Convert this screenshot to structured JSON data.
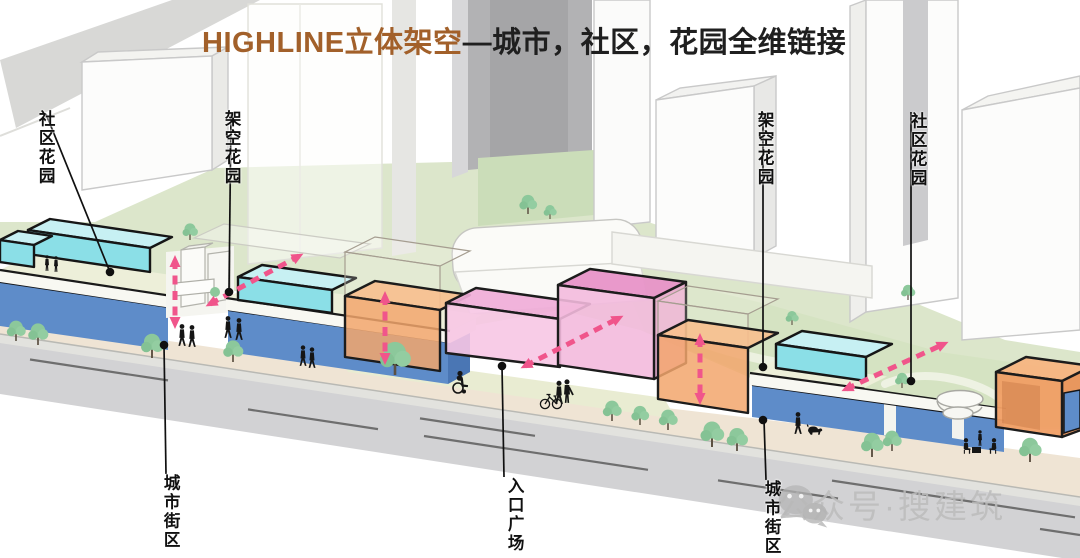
{
  "title": {
    "highlight": "HIGHLINE立体架空",
    "rest": "—城市，社区，花园全维链接"
  },
  "labels": {
    "community_garden_left": "社区花园",
    "elevated_garden_left": "架空花园",
    "elevated_garden_right": "架空花园",
    "community_garden_right": "社区花园",
    "city_block_left": "城市街区",
    "entrance_plaza": "入口广场",
    "city_block_right": "城市街区"
  },
  "watermark": {
    "icon": "wechat-icon",
    "text": "公众号·搜建筑"
  },
  "colors": {
    "title_highlight": "#A2602A",
    "title_text": "#1F1F1F",
    "flow_arrow_pink": "#F0558B",
    "glass_volume_cyan": "#8BDFE7",
    "retail_base_blue": "#5E8CC9",
    "activity_volume_orange": "#F2A76E",
    "entrance_volume_pink": "#F2BCDE",
    "entrance_volume_tall_pink": "#E893C9",
    "lawn_green": "#DCE6CB",
    "roof_garden_green": "#D5E3C2",
    "sidewalk_beige": "#EFE4D4",
    "plaza_pale": "#E9ECD2",
    "road_gray": "#D2D2D4",
    "deck_cream": "#EDEFD9",
    "tree_green": "#8CC89B",
    "label_text": "#101010",
    "watermark_gray": "#BCBCBC"
  }
}
